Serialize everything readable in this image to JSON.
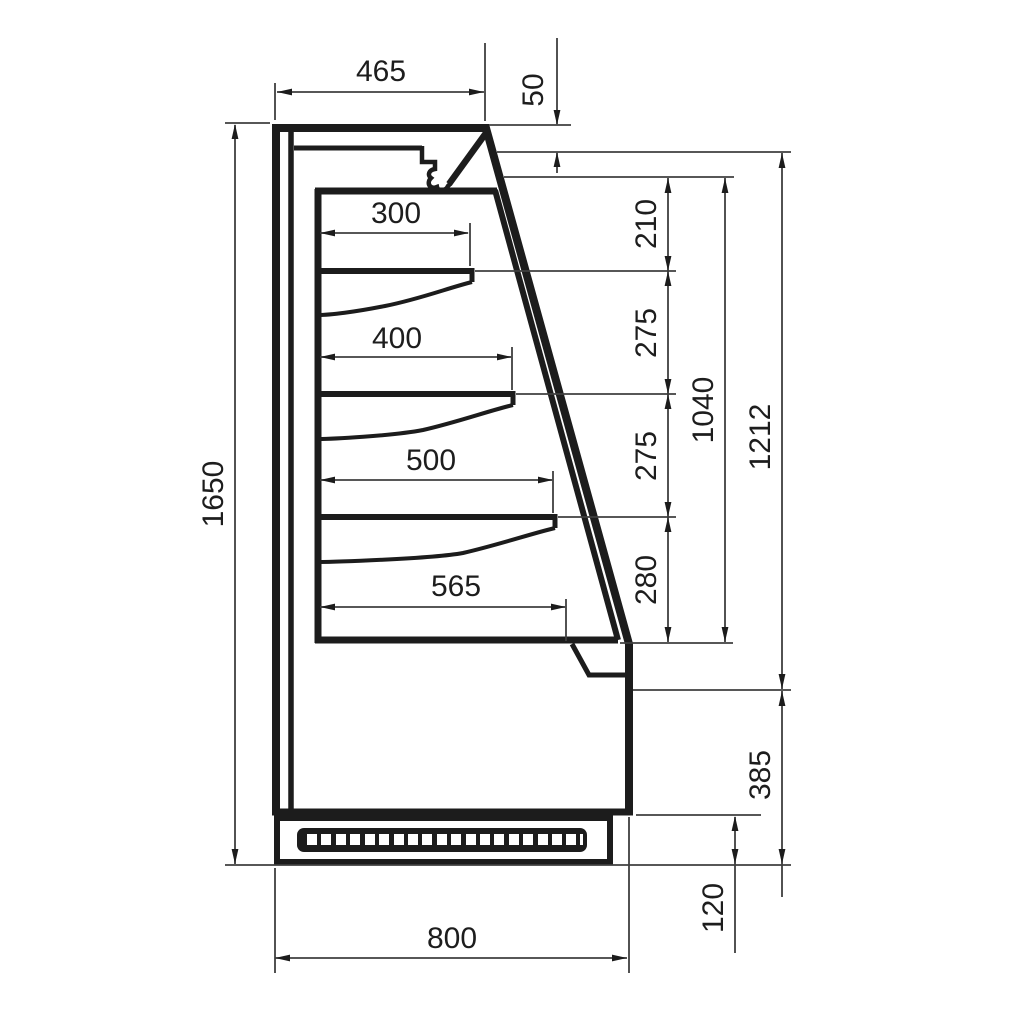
{
  "drawing": {
    "kind": "technical-section-drawing",
    "subject": "open-front refrigerated display case, side cross-section with shelves",
    "units": "mm",
    "colors": {
      "line": "#1c1c1c",
      "thin_line": "#3f3f3f",
      "background": "#ffffff"
    },
    "dims": {
      "top_depth": "465",
      "canopy_drop": "50",
      "shelf1_depth": "300",
      "shelf2_depth": "400",
      "shelf3_depth": "500",
      "deck_depth": "565",
      "gap_ceiling_shelf1": "210",
      "gap_shelf1_shelf2": "275",
      "gap_shelf2_shelf3": "275",
      "gap_shelf3_deck": "280",
      "opening_height": "1040",
      "front_height": "1212",
      "lower_front_height": "385",
      "plinth_height": "120",
      "overall_height": "1650",
      "overall_depth": "800"
    }
  }
}
